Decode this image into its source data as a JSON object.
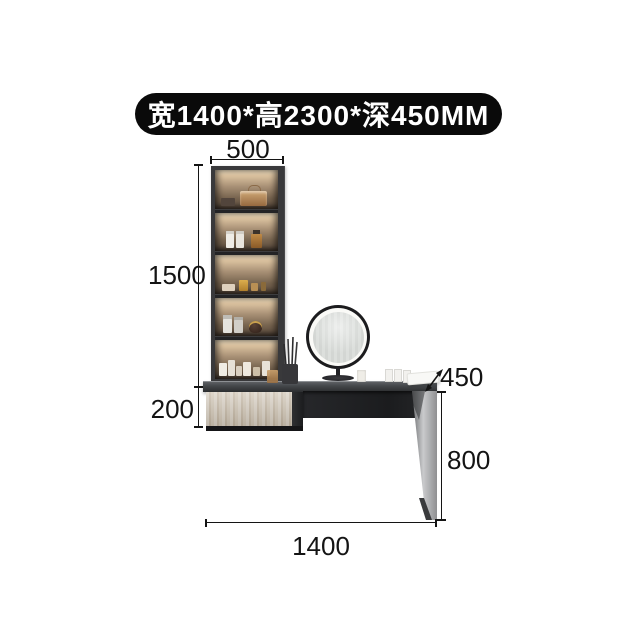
{
  "banner": {
    "text": "宽1400*高2300*深450MM",
    "bg_color": "#0a0a0a",
    "text_color": "#ffffff"
  },
  "dimensions": {
    "shelf_width": "500",
    "shelf_height": "1500",
    "drawer_height": "200",
    "desk_depth": "450",
    "leg_height": "800",
    "total_width": "1400"
  },
  "annotation": {
    "line_color": "#141414",
    "unit": "MM"
  },
  "furniture": {
    "type": "vanity dressing table with shelf cabinet, drawer, LED mirror and desk",
    "accent_led_color": "#f4e4c6",
    "wood_color": "#cfc4b3",
    "frame_color": "#39393b"
  }
}
